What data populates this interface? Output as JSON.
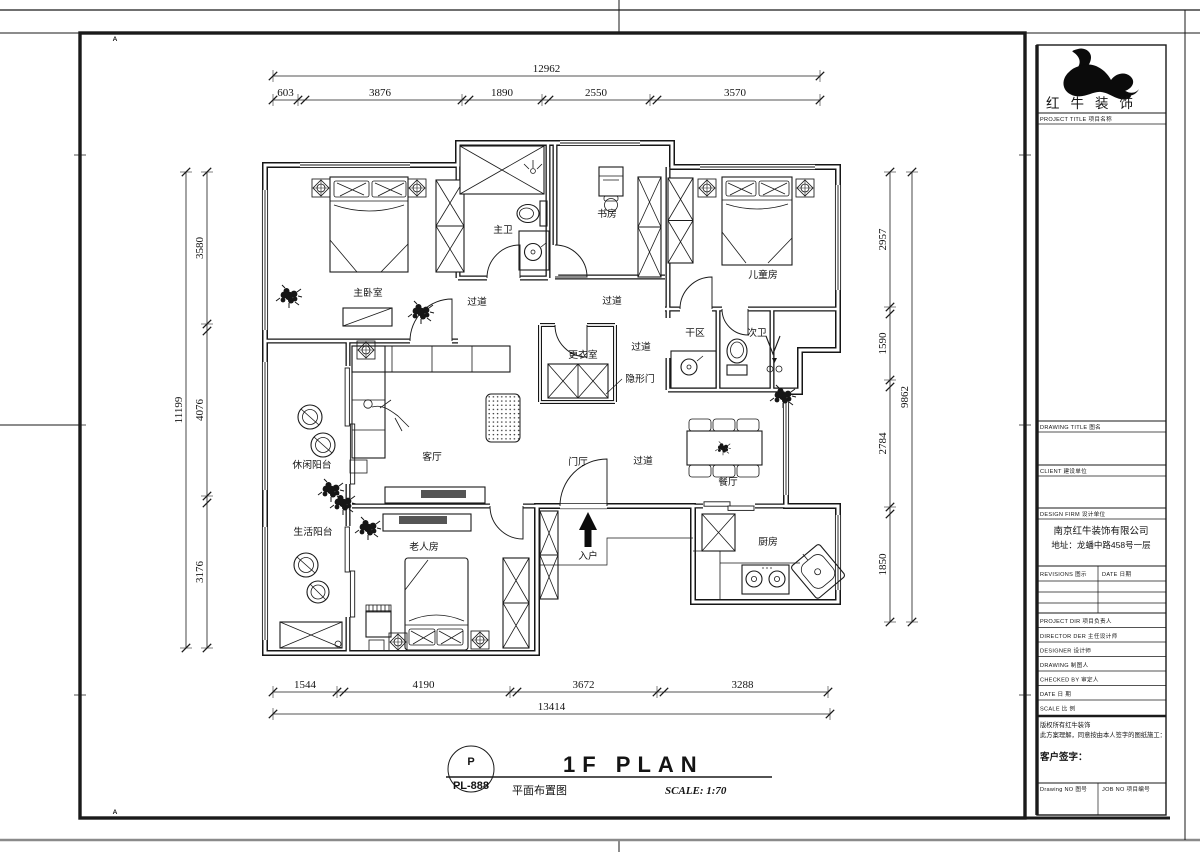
{
  "sheet": {
    "grid_letters": [
      "A",
      "B",
      "C",
      "D",
      "E",
      "F",
      "G",
      "H",
      "I",
      "J",
      "K"
    ]
  },
  "plan": {
    "rooms": {
      "master_bedroom": "主卧室",
      "master_bath": "主卫",
      "study": "书房",
      "kids_room": "儿童房",
      "corridor": "过道",
      "dry_area": "干区",
      "second_bath": "次卫",
      "dressing_room": "更衣室",
      "hidden_door": "隐形门",
      "leisure_balcony": "休闲阳台",
      "living_room": "客厅",
      "utility_balcony": "生活阳台",
      "elder_room": "老人房",
      "foyer": "门厅",
      "dining_room": "餐厅",
      "entry": "入户",
      "kitchen": "厨房"
    },
    "dimensions": {
      "top": {
        "total": "12962",
        "segments": [
          "603",
          "3876",
          "1890",
          "2550",
          "3570"
        ]
      },
      "bottom": {
        "total": "13414",
        "segments": [
          "1544",
          "4190",
          "3672",
          "3288"
        ]
      },
      "left": {
        "total": "11199",
        "segments": [
          "3580",
          "4076",
          "3176"
        ]
      },
      "right": {
        "total": "9862",
        "segments": [
          "2957",
          "1590",
          "2784",
          "1850"
        ]
      }
    }
  },
  "title_bar": {
    "code_letter": "P",
    "code": "PL-888",
    "title_en": "1F PLAN",
    "title_cn": "平面布置图",
    "scale": "SCALE: 1:70"
  },
  "title_block": {
    "logo_name": "红牛装饰",
    "project_title": "PROJECT TITLE 项目名称",
    "drawing_title": "DRAWING TITLE 图名",
    "client": "CLIENT 建设单位",
    "design_firm": "DESIGN FIRM 设计单位",
    "firm_name": "南京红牛装饰有限公司",
    "firm_addr": "地址：龙蟠中路458号一层",
    "revisions": "REVISIONS 图示",
    "date_col": "DATE 日期",
    "project_dir": "PROJECT DIR  项目负责人",
    "director": "DIRECTOR DER 主任设计师",
    "designer": "DESIGNER  设计师",
    "drawing": "DRAWING  制图人",
    "checked": "CHECKED BY  审定人",
    "date": "DATE  日 期",
    "scale": "SCALE  比 例",
    "copyright": "版权所有红牛装饰",
    "note": "此方案理解，同意按由本人签字的图纸施工：",
    "signature": "客户签字：",
    "drawing_no": "Drawing NO 图号",
    "job_no": "JOB NO 项目编号"
  }
}
